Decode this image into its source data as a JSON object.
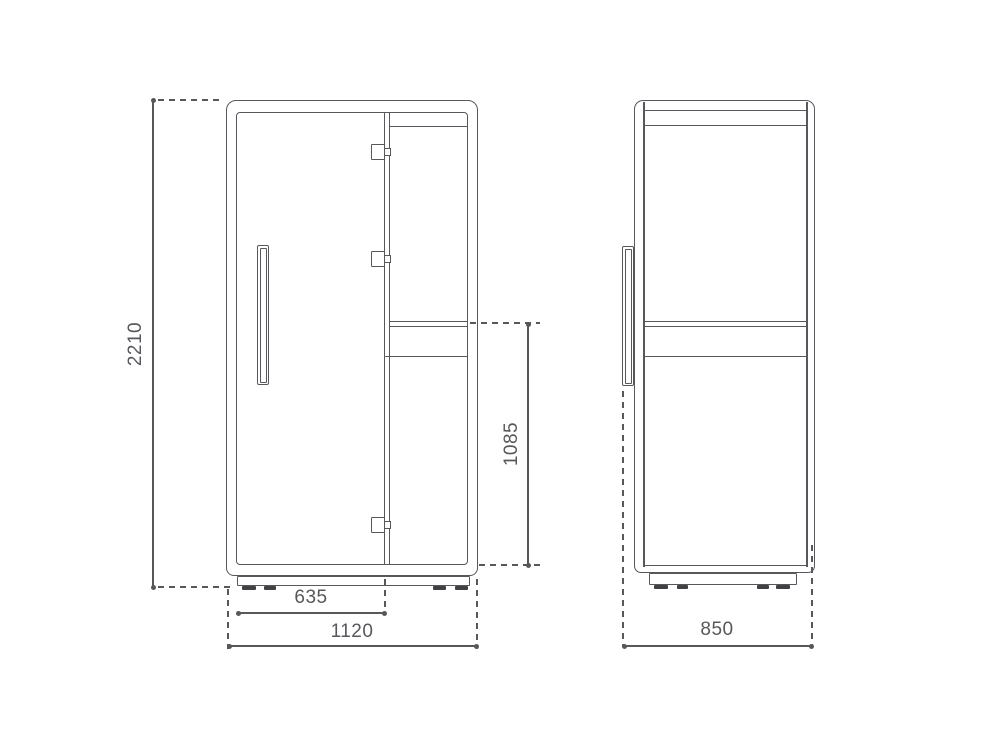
{
  "colors": {
    "line_gray": "#56585c",
    "feet_dark": "#3f4145",
    "background": "#ffffff"
  },
  "front_view": {
    "overall_height": "2210",
    "worktop_height": "1085",
    "door_width": "635",
    "overall_width": "1120"
  },
  "side_view": {
    "overall_depth": "850"
  }
}
